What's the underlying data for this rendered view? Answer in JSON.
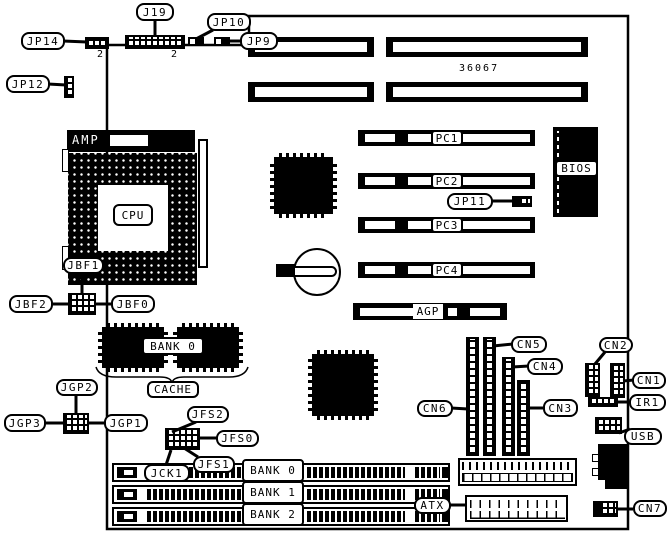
{
  "board": {
    "part_number": "36067",
    "pin2_marker": "2",
    "cpu_socket_brand": "AMP"
  },
  "labels": {
    "j19": "J19",
    "jp10": "JP10",
    "jp14": "JP14",
    "jp9": "JP9",
    "jp12": "JP12",
    "cpu": "CPU",
    "jbf1": "JBF1",
    "jbf2": "JBF2",
    "jbf0": "JBF0",
    "cache_bank0": "BANK 0",
    "cache": "CACHE",
    "jgp2": "JGP2",
    "jgp3": "JGP3",
    "jgp1": "JGP1",
    "jfs2": "JFS2",
    "jfs0": "JFS0",
    "jfs1": "JFS1",
    "jck1": "JCK1",
    "pc1": "PC1",
    "pc2": "PC2",
    "pc3": "PC3",
    "pc4": "PC4",
    "jp11": "JP11",
    "agp": "AGP",
    "bios": "BIOS",
    "cn5": "CN5",
    "cn4": "CN4",
    "cn2": "CN2",
    "cn1": "CN1",
    "cn6": "CN6",
    "cn3": "CN3",
    "ir1": "IR1",
    "usb": "USB",
    "cn7": "CN7",
    "atx": "ATX",
    "bank0": "BANK 0",
    "bank1": "BANK 1",
    "bank2": "BANK 2"
  }
}
